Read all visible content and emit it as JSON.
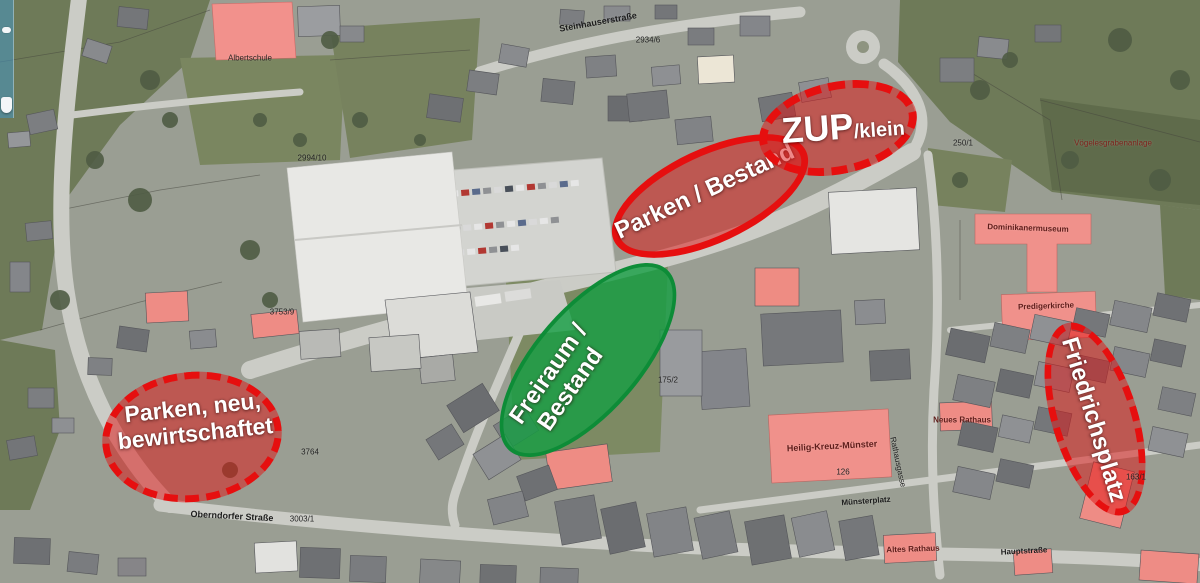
{
  "annotations": {
    "colors": {
      "red_fill": "rgba(224,18,18,0.5)",
      "red_border": "#e60f0f",
      "green_fill": "rgba(20,158,66,0.8)",
      "green_border": "rgba(13,140,55,0.95)",
      "text": "#ffffff"
    },
    "ellipses": [
      {
        "id": "parken-neu-bewirtschaftet",
        "shape": {
          "cx": 192,
          "cy": 437,
          "rx": 90,
          "ry": 65,
          "rot": -6,
          "border": "dashed",
          "color": "red",
          "border_width": 7
        },
        "label": {
          "x": 194,
          "y": 421,
          "rot": -6,
          "size": 23,
          "lines": [
            "Parken, neu,",
            "bewirtschaftet"
          ]
        }
      },
      {
        "id": "parken-bestand",
        "shape": {
          "cx": 710,
          "cy": 196,
          "rx": 106,
          "ry": 47,
          "rot": -25,
          "border": "solid",
          "color": "red",
          "border_width": 7
        },
        "label": {
          "x": 705,
          "y": 192,
          "rot": -25,
          "size": 24,
          "lines": [
            "Parken / Bestand"
          ]
        }
      },
      {
        "id": "zup-klein",
        "shape": {
          "cx": 838,
          "cy": 128,
          "rx": 80,
          "ry": 46,
          "rot": -12,
          "border": "dashed",
          "color": "red",
          "border_width": 8
        },
        "label": {
          "x": 843,
          "y": 127,
          "rot": -4,
          "size": 36,
          "main": "ZUP",
          "sub": "/klein",
          "sub_size": 20
        }
      },
      {
        "id": "freiraum-bestand",
        "shape": {
          "cx": 588,
          "cy": 360,
          "rx": 120,
          "ry": 53,
          "rot": -49,
          "border": "solid",
          "color": "green",
          "border_width": 4
        },
        "label": {
          "x": 560,
          "y": 382,
          "rot": -55,
          "size": 24,
          "lines": [
            "Freiraum /",
            "Bestand"
          ]
        }
      },
      {
        "id": "friedrichsplatz",
        "shape": {
          "cx": 1095,
          "cy": 419,
          "rx": 100,
          "ry": 43,
          "rot": 73,
          "border": "dashed",
          "color": "red",
          "border_width": 7
        },
        "label": {
          "x": 1093,
          "y": 420,
          "rot": 73,
          "size": 24,
          "lines": [
            "Friedrichsplatz"
          ]
        }
      }
    ]
  },
  "map_labels": [
    {
      "text": "Steinhauserstraße",
      "x": 598,
      "y": 22,
      "rot": -10,
      "size": 9,
      "color": "#1c1c1c",
      "bold": true
    },
    {
      "text": "Albertschule",
      "x": 250,
      "y": 58,
      "rot": 0,
      "size": 8,
      "color": "#2b2320",
      "bold": false
    },
    {
      "text": "2994/10",
      "x": 312,
      "y": 158,
      "rot": 0,
      "size": 8,
      "color": "#222222",
      "bold": false
    },
    {
      "text": "2934/6",
      "x": 648,
      "y": 40,
      "rot": 0,
      "size": 8,
      "color": "#222222",
      "bold": false
    },
    {
      "text": "3753/9",
      "x": 282,
      "y": 312,
      "rot": 0,
      "size": 8,
      "color": "#222222",
      "bold": false
    },
    {
      "text": "3764",
      "x": 310,
      "y": 452,
      "rot": 0,
      "size": 8,
      "color": "#222222",
      "bold": false
    },
    {
      "text": "3003/1",
      "x": 302,
      "y": 519,
      "rot": 0,
      "size": 8,
      "color": "#222222",
      "bold": false
    },
    {
      "text": "Oberndorfer Straße",
      "x": 232,
      "y": 516,
      "rot": 3,
      "size": 9,
      "color": "#1c1c1c",
      "bold": true
    },
    {
      "text": "Dominikanermuseum",
      "x": 1028,
      "y": 228,
      "rot": 2,
      "size": 8,
      "color": "#5e1d1a",
      "bold": true
    },
    {
      "text": "Predigerkirche",
      "x": 1046,
      "y": 306,
      "rot": -2,
      "size": 8,
      "color": "#5e1d1a",
      "bold": true
    },
    {
      "text": "Heilig-Kreuz-Münster",
      "x": 832,
      "y": 446,
      "rot": -3,
      "size": 9,
      "color": "#5e1d1a",
      "bold": true
    },
    {
      "text": "Münsterplatz",
      "x": 866,
      "y": 501,
      "rot": -4,
      "size": 8,
      "color": "#1c1c1c",
      "bold": true
    },
    {
      "text": "126",
      "x": 843,
      "y": 472,
      "rot": 0,
      "size": 8,
      "color": "#222222",
      "bold": false
    },
    {
      "text": "Neues Rathaus",
      "x": 962,
      "y": 420,
      "rot": 0,
      "size": 8,
      "color": "#5e1d1a",
      "bold": true
    },
    {
      "text": "Rathausgasse",
      "x": 898,
      "y": 462,
      "rot": 78,
      "size": 8,
      "color": "#1c1c1c",
      "bold": false
    },
    {
      "text": "Altes Rathaus",
      "x": 913,
      "y": 549,
      "rot": -2,
      "size": 8,
      "color": "#5e1d1a",
      "bold": true
    },
    {
      "text": "Hauptstraße",
      "x": 1024,
      "y": 551,
      "rot": -3,
      "size": 8,
      "color": "#1c1c1c",
      "bold": true
    },
    {
      "text": "Vögelesgrabenanlage",
      "x": 1113,
      "y": 143,
      "rot": 0,
      "size": 8,
      "color": "#7e221c",
      "bold": false
    },
    {
      "text": "250/1",
      "x": 963,
      "y": 143,
      "rot": 0,
      "size": 8,
      "color": "#222222",
      "bold": false
    },
    {
      "text": "175/2",
      "x": 668,
      "y": 380,
      "rot": 0,
      "size": 8,
      "color": "#222222",
      "bold": false
    },
    {
      "text": "163/1",
      "x": 1136,
      "y": 477,
      "rot": 0,
      "size": 8,
      "color": "#222222",
      "bold": false
    }
  ]
}
